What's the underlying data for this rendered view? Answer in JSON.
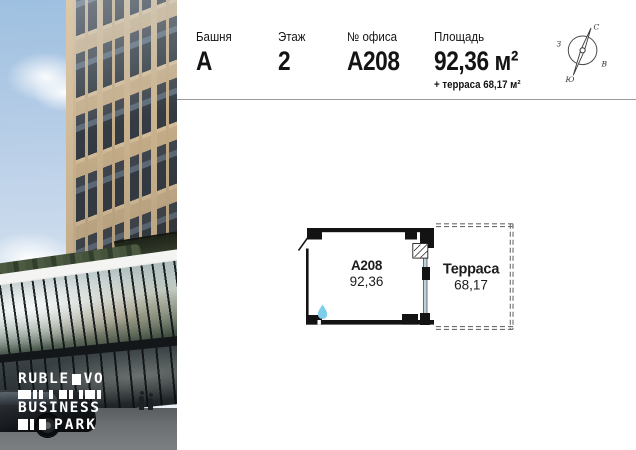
{
  "header": {
    "columns": [
      {
        "label": "Башня",
        "value": "А"
      },
      {
        "label": "Этаж",
        "value": "2"
      },
      {
        "label": "№ офиса",
        "value": "А208"
      },
      {
        "label": "Площадь",
        "value": "92,36 м²",
        "sub": "+ терраса 68,17 м²"
      }
    ],
    "compass": {
      "north": "С",
      "south": "Ю",
      "west": "З",
      "east": "В"
    }
  },
  "plan": {
    "room": {
      "label": "А208",
      "area": "92,36"
    },
    "terrace": {
      "label": "Терраса",
      "area": "68,17"
    }
  },
  "logo": {
    "word1_left": "RUBLE",
    "word1_right": "VO",
    "word2": "BUSINESS",
    "word3": "PARK"
  },
  "colors": {
    "wall": "#131313",
    "dash": "#6e6e6e",
    "glazing": "#bdd2dc",
    "water_drop": "#7ecdea",
    "facade_beige": "#c9b18c",
    "divider": "#9a9a9a"
  }
}
